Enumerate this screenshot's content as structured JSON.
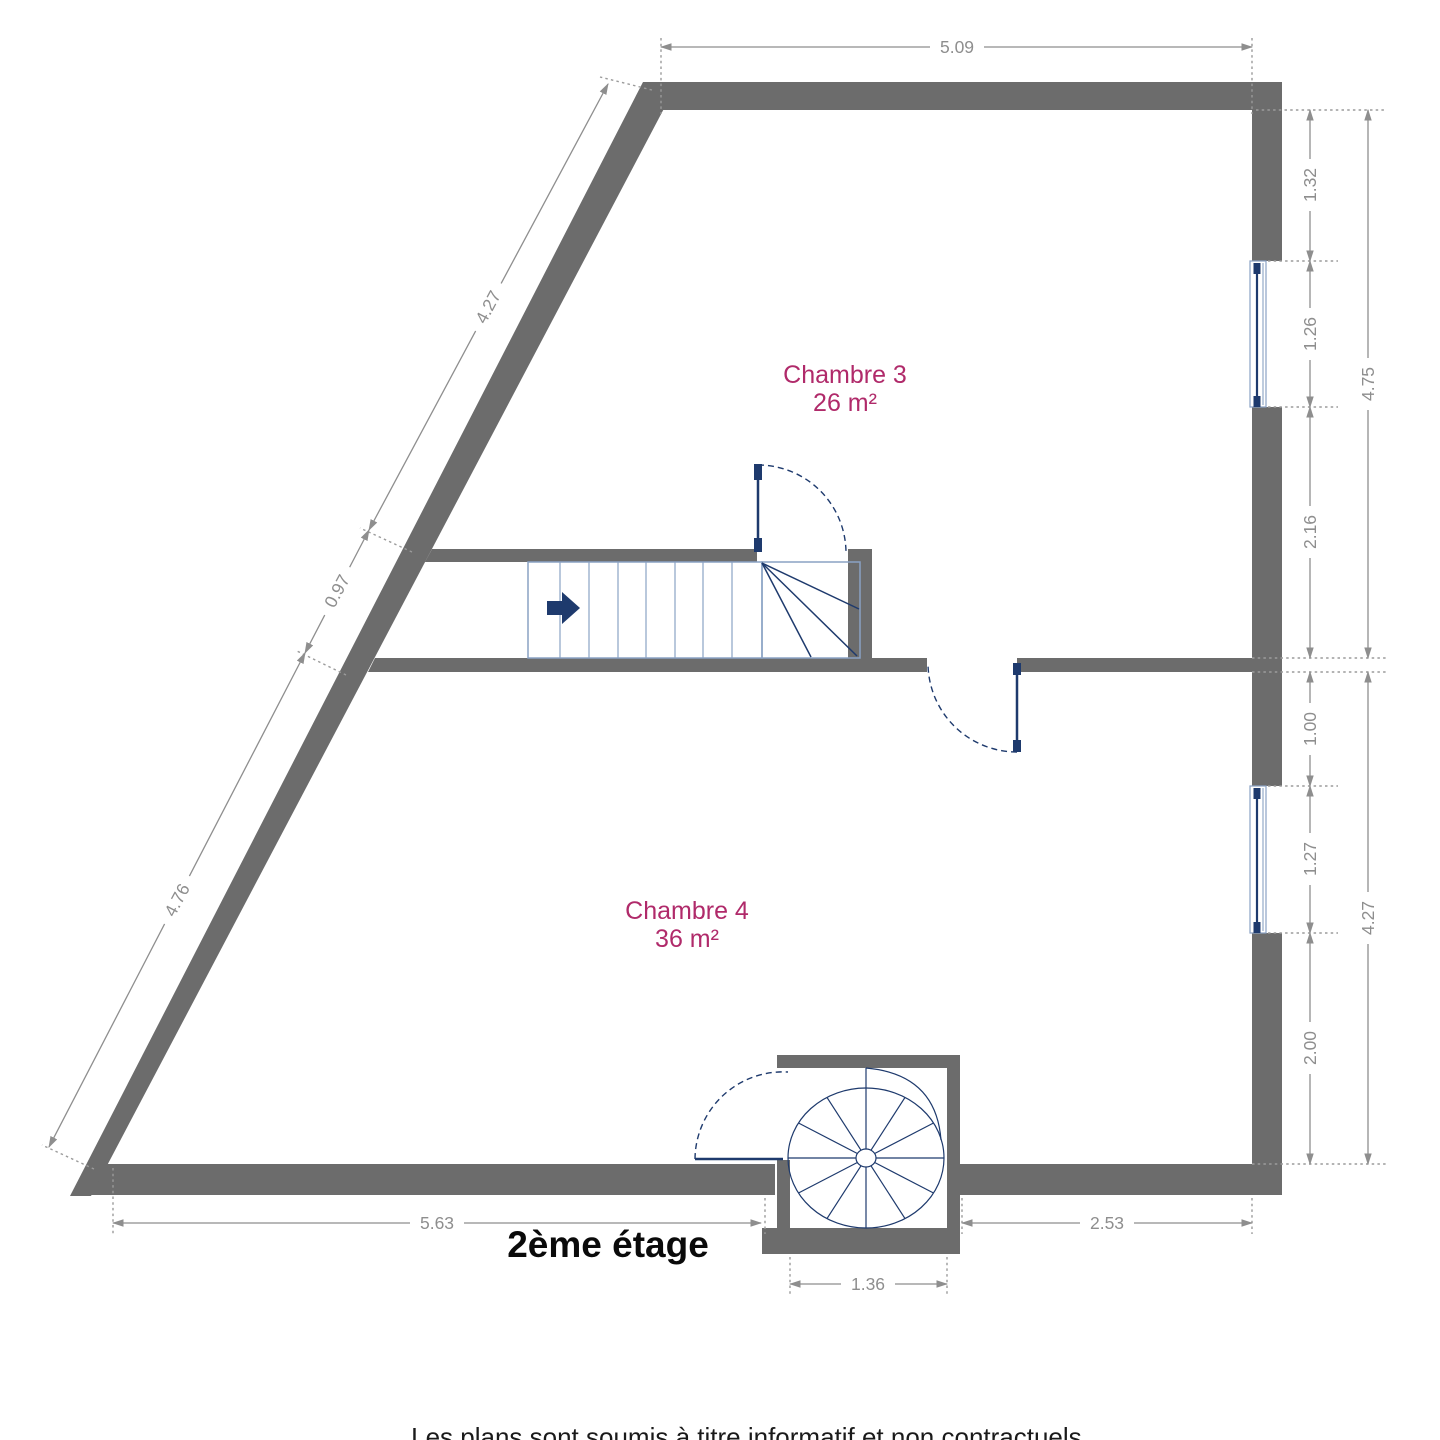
{
  "title": "2ème étage",
  "footer": "Les plans sont soumis à titre informatif et non contractuels.",
  "rooms": [
    {
      "name": "Chambre 3",
      "area": "26 m²"
    },
    {
      "name": "Chambre 4",
      "area": "36 m²"
    }
  ],
  "dims": {
    "top": "5.09",
    "right_upper": [
      "1.32",
      "1.26",
      "2.16"
    ],
    "right_upper_total": "4.75",
    "right_lower": [
      "1.00",
      "1.27",
      "2.00"
    ],
    "right_lower_total": "4.27",
    "left": [
      "4.27",
      "0.97",
      "4.76"
    ],
    "bottom_left": "5.63",
    "bottom_right": "2.53",
    "stair_well": "1.36"
  },
  "colors": {
    "wall": "#6c6c6c",
    "dimension": "#8e8e8e",
    "navy": "#1e3a6d",
    "light_blue": "#8aa2c4",
    "room_label": "#b02a6a",
    "ink": "#111111"
  }
}
